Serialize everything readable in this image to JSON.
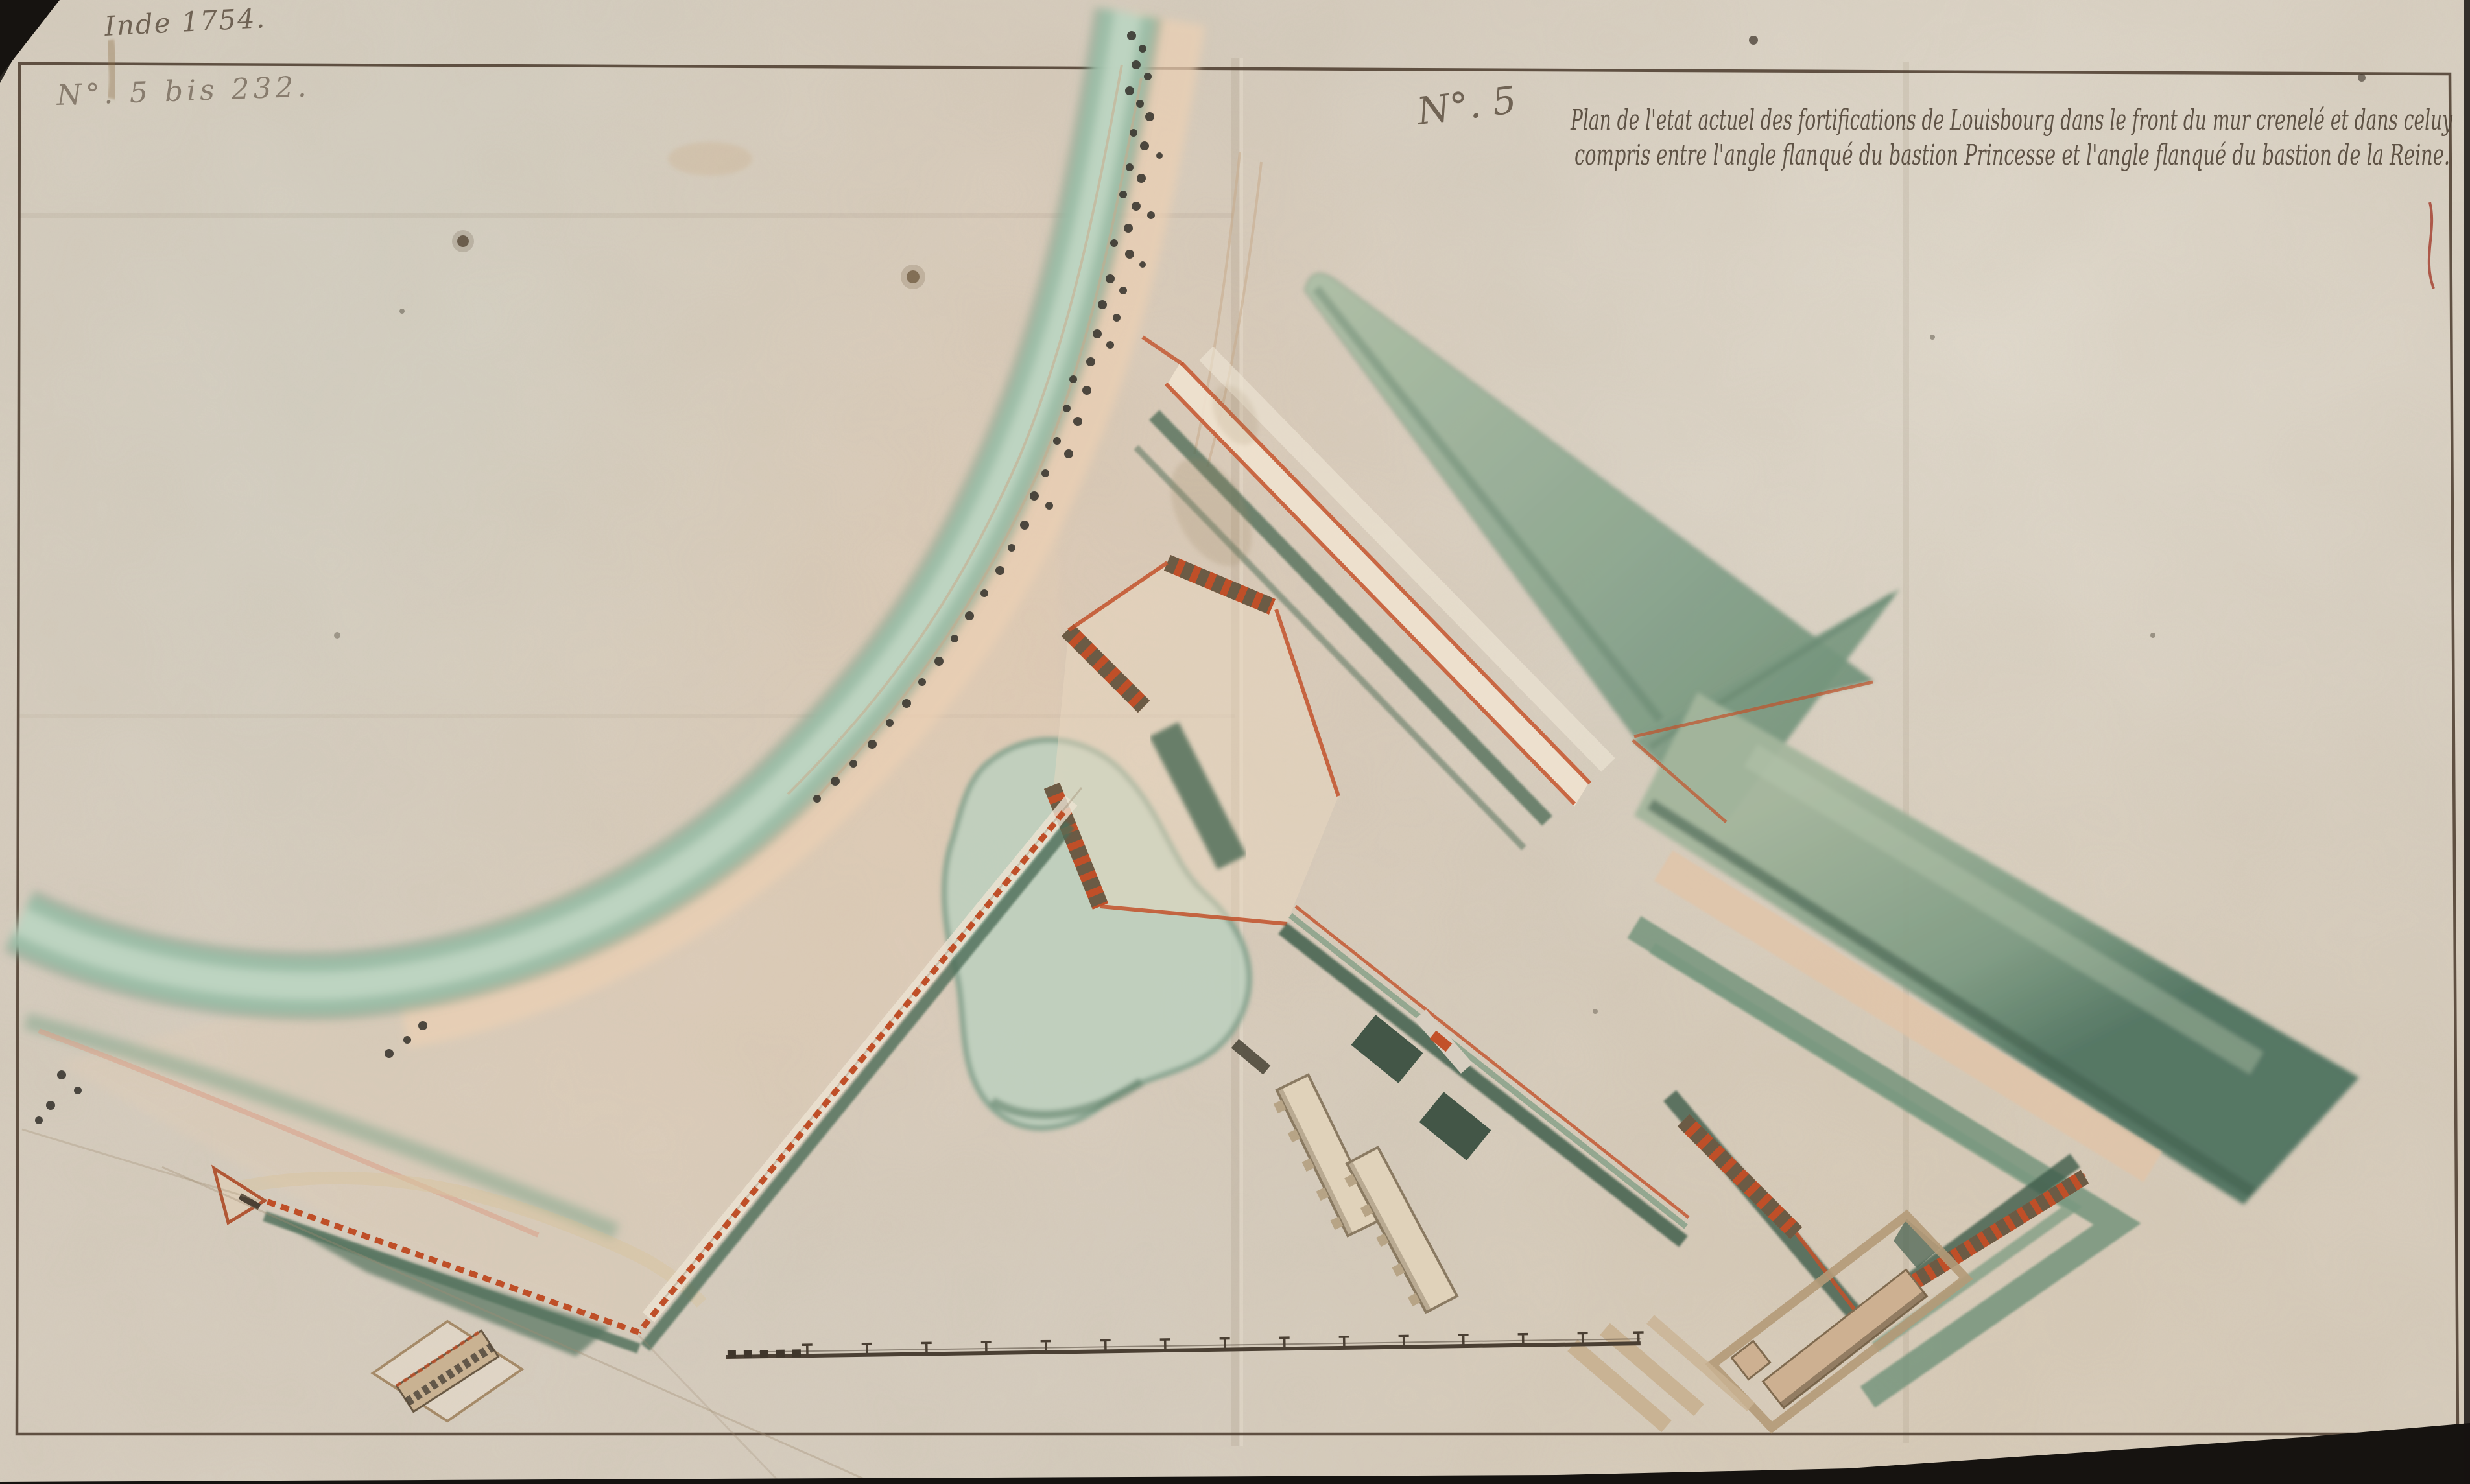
{
  "map": {
    "kind": "manuscript fortification plan, pen and watercolour on laid paper",
    "subject": "Fortifications of Louisbourg — front of the crenellated wall between bastion Princesse and bastion de la Reine",
    "marks": {
      "date_inscription": "Inde 1754.",
      "catalog_number_red": "N°. 5 bis 232.",
      "sheet_number": "N°. 5"
    },
    "title": {
      "line1": "Plan de l'etat actuel des fortifications de Louisbourg dans le front du mur crenelé et dans celuy",
      "line2": "compris entre l'angle flanqué du bastion Princesse et l'angle flanqué du bastion de la Reine."
    },
    "scale_bar": {
      "major_divisions": 14,
      "subdivided_left_segment": true,
      "label": ""
    },
    "features": [
      "border-frame",
      "vertical-fold-creases",
      "shoreline-stream",
      "beach-band",
      "tree-symbols",
      "pond",
      "glacis-wedges",
      "covered-way-bands",
      "bastion-princesse-ramparts",
      "bastion-de-la-reine-ramparts",
      "crenellated-wall-red-dashed",
      "curtain-wall",
      "barracks-buildings",
      "garden-plots",
      "fortified-compound",
      "powder-magazine-diamond",
      "scale-bar",
      "ink-stains"
    ],
    "palette": {
      "paper": "#d7cec0",
      "beach_pink": "#e8ceb2",
      "water_green": "#9dbfa9",
      "glacis_green": "#7f9c85",
      "ditch_dark_green": "#44604e",
      "wall_red": "#bf4f28",
      "rampart_brown": "#6b5b45",
      "building_beige": "#cdb091",
      "ink_brown": "#4a3f33",
      "red_ink": "#bb604a"
    }
  }
}
